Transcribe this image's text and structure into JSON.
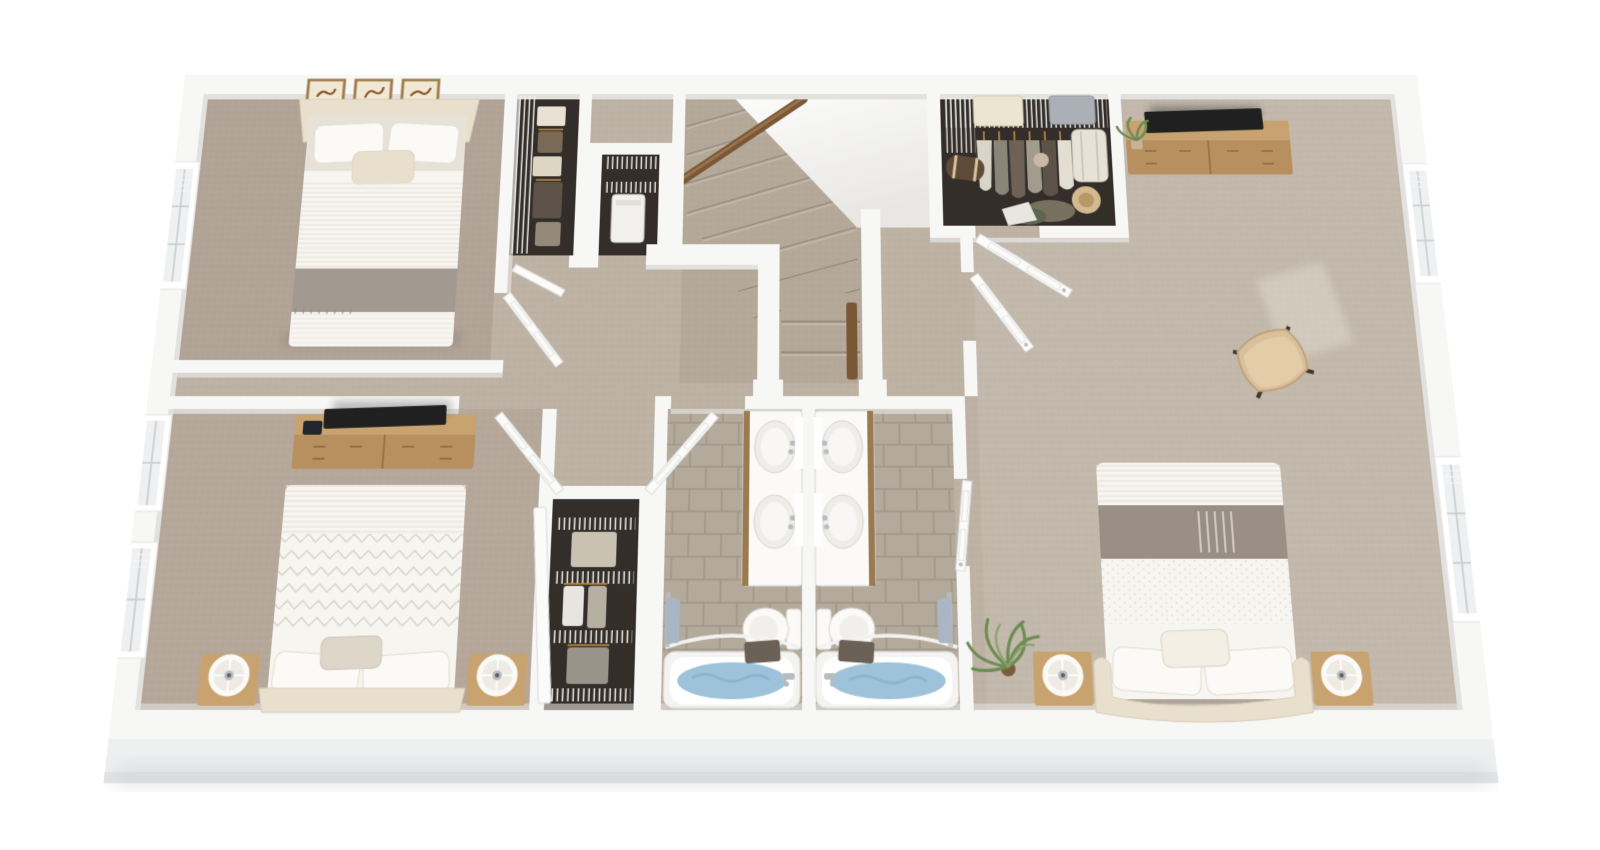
{
  "scene": {
    "kind": "3d-floor-plan-rendering",
    "floor": "upper-floor",
    "view": "top-down perspective dollhouse view",
    "visible_text": "none"
  },
  "palette": {
    "bg": "#ffffff",
    "slab": "#eeeff0",
    "slab-edge": "#e2e3e5",
    "wall": "#f7f7f6",
    "wall-face": "#e2e1de",
    "carpet-hall": "#bdb2a4",
    "carpet-bed2": "#b1a396",
    "carpet-bed3": "#b5a79a",
    "carpet-master": "#c2b8ab",
    "carpet-stairs": "#b4a899",
    "tile": "#b4aa9b",
    "grout": "#a2978a",
    "closet-floor": "#332e2a",
    "wood": "#b8905f",
    "wood-dark": "#8f6b42",
    "wood-light": "#c9a36f",
    "rail-wood": "#7a5836",
    "linen": "#f7f5f0",
    "linen-shadow": "#e7e2d8",
    "headboard": "#e8e0cd",
    "throw-gray": "#a29a90",
    "throw-gray2": "#998f85",
    "water": "#9dc2da",
    "water-deep": "#7fa9c6",
    "towel-blue": "#aab6c4",
    "towel-dark": "#6a6055",
    "chair-tan": "#d9bf9b",
    "plant-green": "#6d8c55",
    "tv": "#202020",
    "chrome": "#b9bcbf",
    "frame-wood": "#a07c4c"
  },
  "rooms": [
    {
      "id": "bedroom-top-left",
      "type": "bedroom",
      "furniture": [
        "upholstered-bed",
        "three-wall-art-frames",
        "window-with-blinds",
        "reach-in-closet"
      ]
    },
    {
      "id": "bedroom-bottom-left",
      "type": "bedroom",
      "furniture": [
        "bed-chevron-duvet",
        "dresser-with-tv-and-book",
        "two-nightstands-with-drum-lamps",
        "two-windows-with-blinds",
        "reach-in-closet"
      ]
    },
    {
      "id": "master-bedroom",
      "type": "bedroom",
      "furniture": [
        "bed-with-gray-throw",
        "dresser-with-tv-and-plant",
        "accent-chair",
        "palm-plant",
        "two-nightstands-with-drum-lamps",
        "two-windows-with-blinds",
        "sunlight-patches"
      ]
    },
    {
      "id": "walk-in-closet",
      "type": "closet",
      "contents": [
        "wire-shelving",
        "hanging-clothes",
        "duffel-bag",
        "suitcase",
        "sun-hat",
        "linen-stacks"
      ]
    },
    {
      "id": "bathroom-left",
      "type": "bathroom",
      "fixtures": [
        "double-sink-vanity",
        "toilet",
        "bathtub-with-water",
        "curved-shower-rod",
        "dark-towel",
        "blue-towel-ring",
        "tile-floor"
      ]
    },
    {
      "id": "bathroom-right",
      "type": "bathroom",
      "fixtures": [
        "double-sink-vanity",
        "toilet",
        "bathtub-with-water",
        "curved-shower-rod",
        "dark-towel",
        "blue-towel-ring",
        "tile-floor"
      ]
    },
    {
      "id": "hallway",
      "type": "hall",
      "furniture": []
    },
    {
      "id": "staircase",
      "type": "stairs",
      "parts": [
        "carpeted-treads",
        "wood-handrail",
        "half-walls",
        "landing-steps",
        "ceiling-wedge"
      ]
    },
    {
      "id": "linen-closet",
      "type": "closet",
      "contents": [
        "wire-shelves",
        "hamper"
      ]
    }
  ]
}
